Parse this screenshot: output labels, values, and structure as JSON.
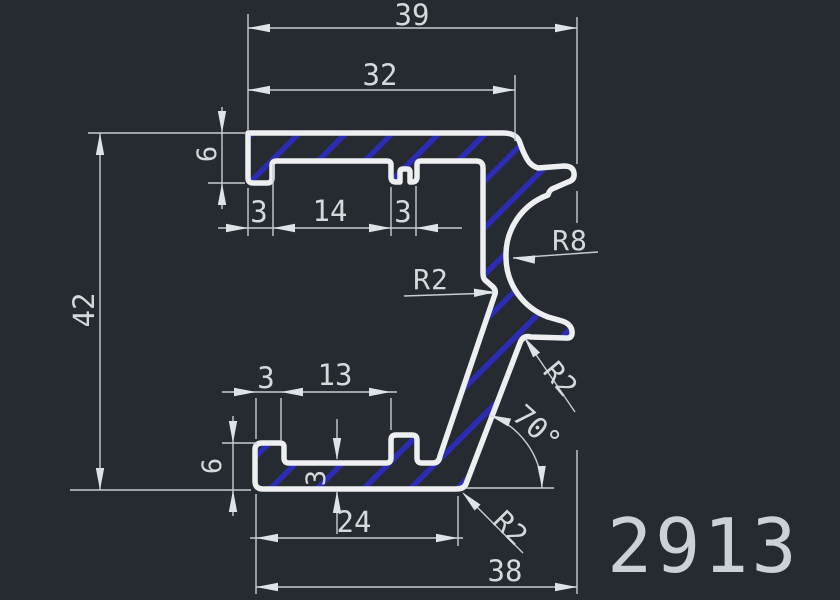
{
  "canvas": {
    "width": 840,
    "height": 600,
    "background": "#262a31"
  },
  "style_colors": {
    "profile_outline": "#edeff1",
    "hatch_fill": "#2c2cb4",
    "dimension_lines": "#c9cdd2",
    "text": "#d6d9dc"
  },
  "part_label": "2913",
  "dimensions": {
    "overall_width_top": "39",
    "top_flange_width": "32",
    "top_flange_thickness": "6",
    "top_lip_width": "3",
    "top_channel_width": "14",
    "top_rib_width": "3",
    "overall_height": "42",
    "wall_fillet_radius": "R2",
    "hook_radius": "R8",
    "notch_fillet_radius": "R2",
    "slant_angle": "70°",
    "bottom_lip_width": "3",
    "bottom_channel_width": "13",
    "bottom_flange_height": "6",
    "floor_thickness": "3",
    "bottom_channel_span": "24",
    "overall_width_bottom": "38",
    "bottom_corner_radius": "R2"
  }
}
